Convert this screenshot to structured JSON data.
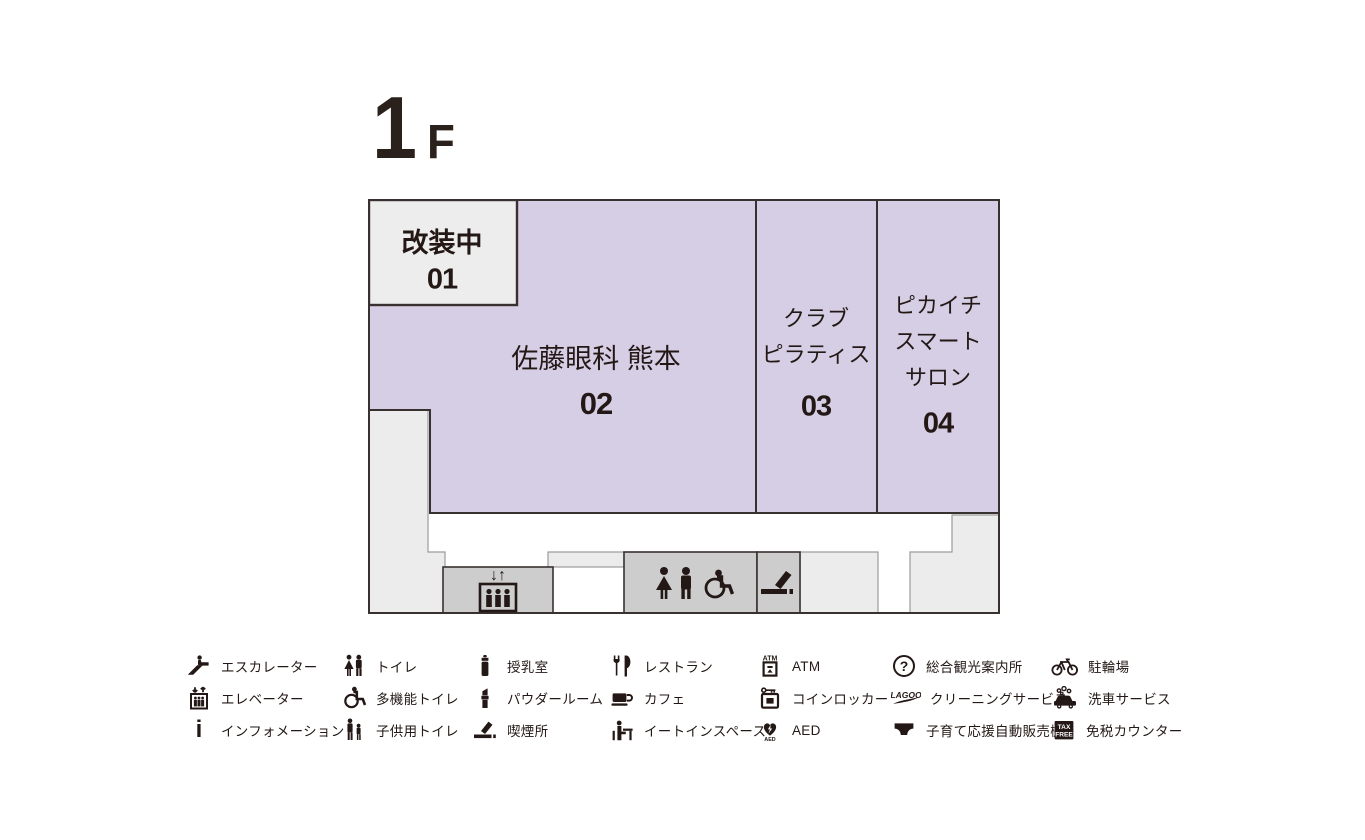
{
  "header": {
    "floor": "1",
    "suffix": "F"
  },
  "colors": {
    "text": "#231815",
    "unit_fill": "#d5cee4",
    "renovation_fill": "#ededed",
    "facility_box_fill": "#cdcdcd",
    "filler_fill": "#ececec",
    "line": "#383130"
  },
  "plan": {
    "units": [
      {
        "number": "01",
        "lines": [
          "改装中"
        ],
        "status": "改装中"
      },
      {
        "number": "02",
        "lines": [
          "佐藤眼科 熊本"
        ]
      },
      {
        "number": "03",
        "lines": [
          "クラブ",
          "ピラティス"
        ]
      },
      {
        "number": "04",
        "lines": [
          "ピカイチ",
          "スマート",
          "サロン"
        ]
      }
    ],
    "facilities": [
      "elevator",
      "toilet",
      "smoking"
    ],
    "elevator_arrows": "↓↑"
  },
  "legend": {
    "icon_text": {
      "info": "i",
      "atm": "ATM",
      "aed": "AED",
      "question": "?",
      "lagoo": "LAGOO",
      "tax": "TAX",
      "free": "FREE"
    },
    "items": [
      {
        "icon": "escalator",
        "label": "エスカレーター"
      },
      {
        "icon": "elevator",
        "label": "エレベーター"
      },
      {
        "icon": "information",
        "label": "インフォメーション"
      },
      {
        "icon": "toilet",
        "label": "トイレ"
      },
      {
        "icon": "accessible-toilet",
        "label": "多機能トイレ"
      },
      {
        "icon": "kids-toilet",
        "label": "子供用トイレ"
      },
      {
        "icon": "nursing-room",
        "label": "授乳室"
      },
      {
        "icon": "powder-room",
        "label": "パウダールーム"
      },
      {
        "icon": "smoking-area",
        "label": "喫煙所"
      },
      {
        "icon": "restaurant",
        "label": "レストラン"
      },
      {
        "icon": "cafe",
        "label": "カフェ"
      },
      {
        "icon": "eat-in-space",
        "label": "イートインスペース"
      },
      {
        "icon": "atm",
        "label": "ATM"
      },
      {
        "icon": "coin-locker",
        "label": "コインロッカー"
      },
      {
        "icon": "aed",
        "label": "AED"
      },
      {
        "icon": "tourist-information",
        "label": "総合観光案内所"
      },
      {
        "icon": "cleaning-service",
        "label": "クリーニングサービス"
      },
      {
        "icon": "child-support-vending",
        "label": "子育て応援自動販売機"
      },
      {
        "icon": "bicycle-parking",
        "label": "駐輪場"
      },
      {
        "icon": "car-wash",
        "label": "洗車サービス"
      },
      {
        "icon": "tax-free-counter",
        "label": "免税カウンター"
      }
    ]
  }
}
